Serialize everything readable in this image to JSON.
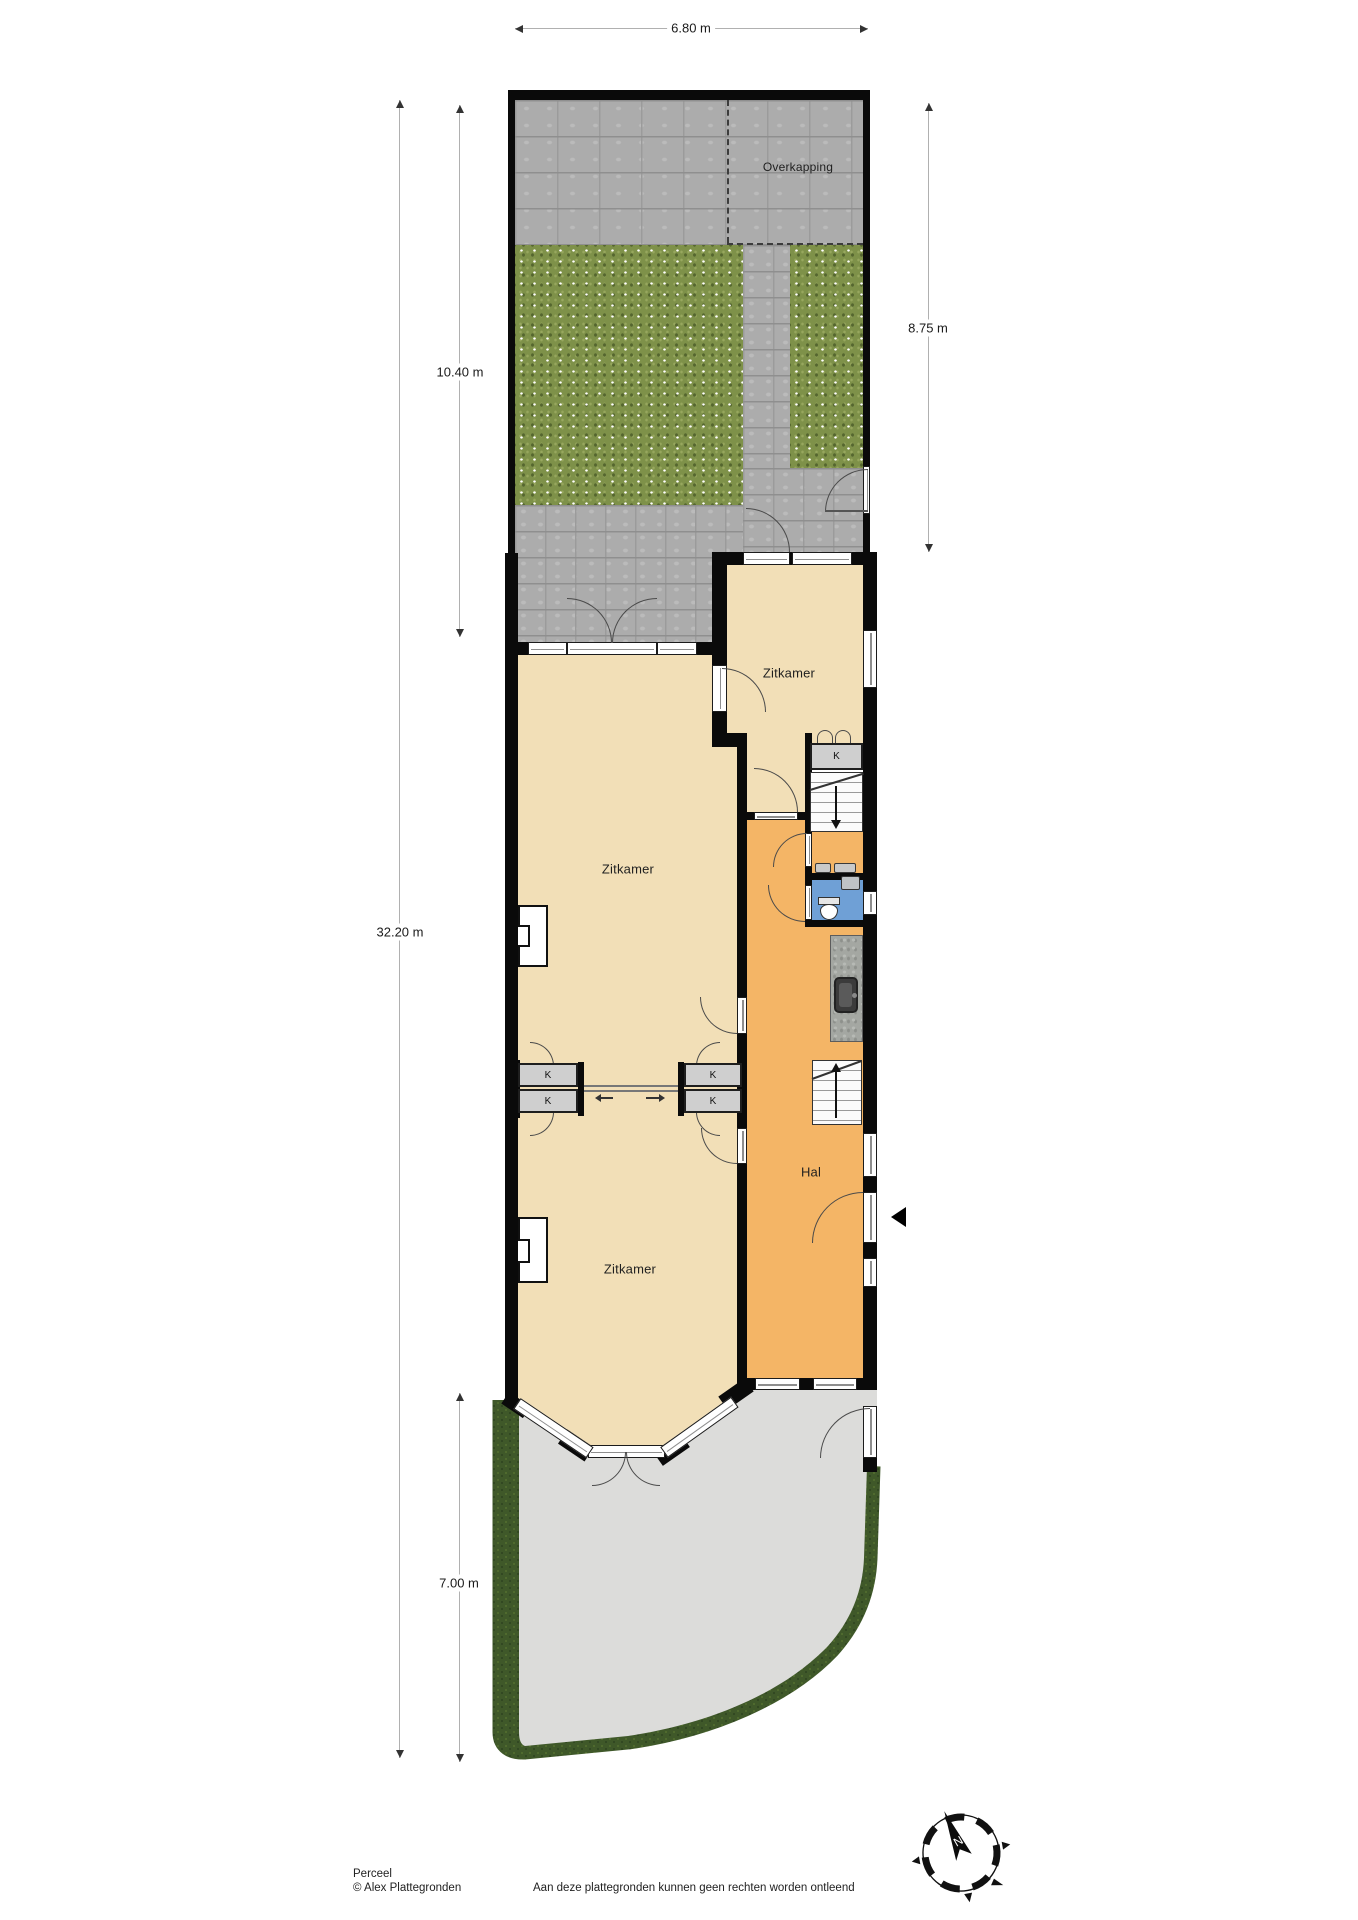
{
  "plan": {
    "labels": {
      "overkapping": "Overkapping",
      "zitkamer_back": "Zitkamer",
      "zitkamer_middle": "Zitkamer",
      "zitkamer_front": "Zitkamer",
      "hal": "Hal",
      "closet_left_top": "K",
      "closet_left_bottom": "K",
      "closet_right_top": "K",
      "closet_right_bottom": "K",
      "closet_stairs": "K"
    },
    "dimensions": {
      "plot_width": "6.80 m",
      "back_garden_left": "10.40 m",
      "back_garden_right": "8.75 m",
      "plot_depth": "32.20 m",
      "front_garden": "7.00 m"
    },
    "compass": {
      "north": "N"
    },
    "footer": {
      "title": "Perceel",
      "copyright": "© Alex Plattegronden",
      "disclaimer": "Aan deze plattegronden kunnen geen rechten worden ontleend"
    },
    "colors": {
      "room_beige": "#F2DFB7",
      "hall_orange": "#F4B566",
      "wc_blue": "#6FA0D6",
      "wall_black": "#0A0A0A",
      "grass_green": "#7E9149",
      "hedge_green": "#3F5829",
      "paver_gray": "#ACACAC",
      "gravel_gray": "#DCDCDA"
    }
  }
}
